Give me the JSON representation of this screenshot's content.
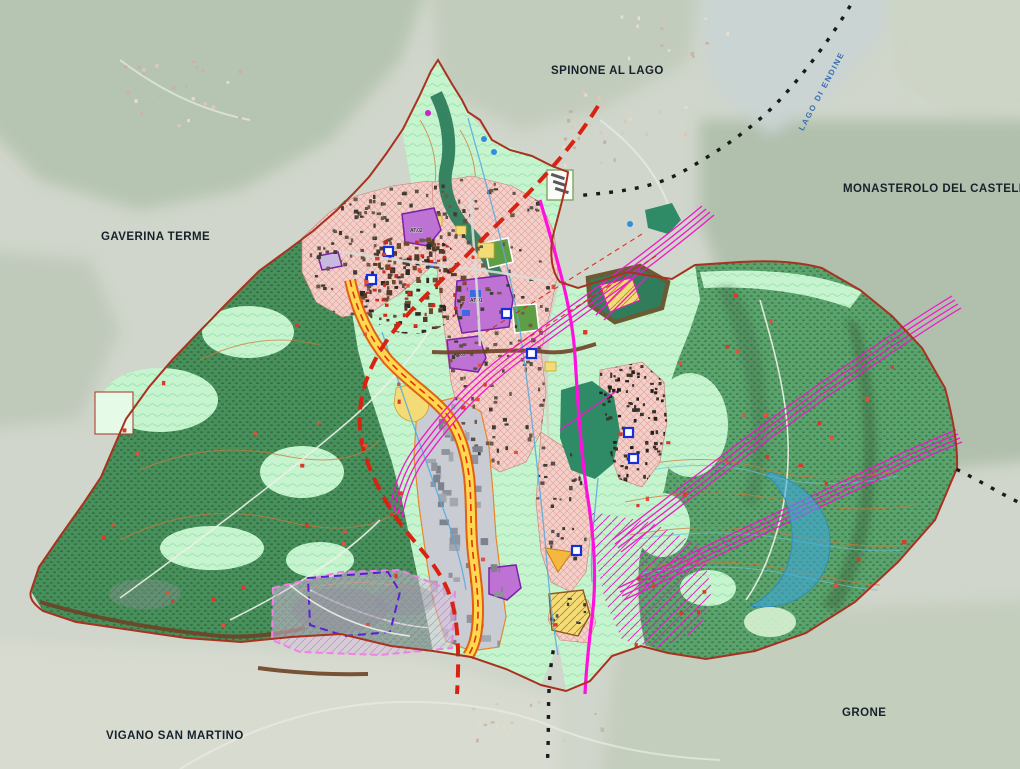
{
  "map": {
    "kind": "municipal zoning plan over aerial photo",
    "neighbors": {
      "spinone": "SPINONE AL LAGO",
      "monasterolo": "MONASTEROLO DEL CASTELLO",
      "gaverina": "GAVERINA TERME",
      "grone": "GRONE",
      "vigano": "VIGANO SAN MARTINO"
    },
    "water": {
      "lake_label": "LAGO DI ENDINE"
    },
    "zone_labels": {
      "at01": "AT.01",
      "at02": "AT.02",
      "at03": "AT.03"
    },
    "colors": {
      "aerial_base": "#d0d6cb",
      "forest_left": "#478f5b",
      "forest_right": "#5aa36c",
      "meadow_mint": "#c6f4cf",
      "urban_pink": "#f3d0ca",
      "industrial_gray": "#c9ccd2",
      "transformation_purple": "#bd72d4",
      "services_yellow": "#f3dc78",
      "road_casing_orange": "#e2590f",
      "road_fill_yellow": "#ffd84d",
      "powerline_magenta": "#ef18c8",
      "constraint_red": "#d82312",
      "boundary_red_brown": "#a8321f",
      "river_teal": "#2e7d5c",
      "hazard_blue": "#3aa8e6",
      "study_area_lavender": "#e6badf"
    }
  }
}
